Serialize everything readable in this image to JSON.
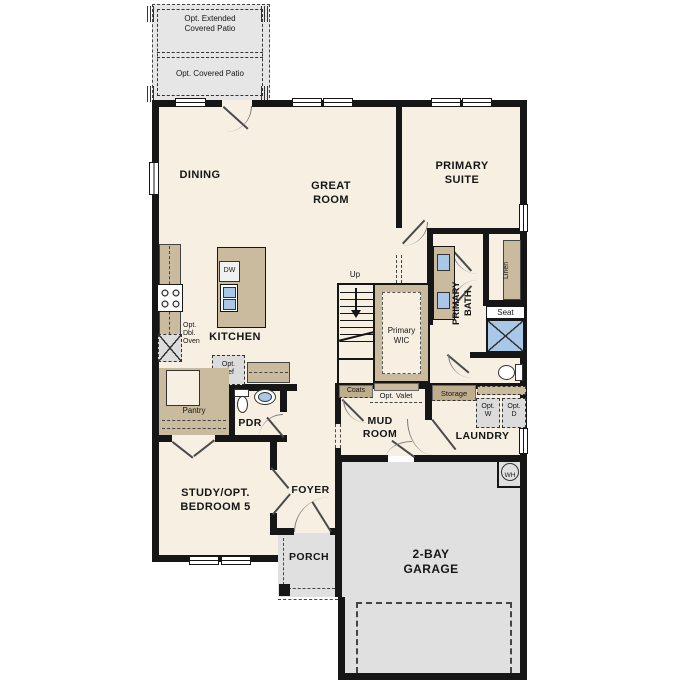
{
  "title": "Single-story floor plan",
  "colors": {
    "floor": "#f6efe2",
    "wall": "#161616",
    "cabinet_tan": "#cabb9f",
    "header_tan": "#bfae8e",
    "garage_gray": "#e0e0e0",
    "fixture_blue": "#a9c7e6",
    "option_box_gray": "#dcdcdc"
  },
  "labels": {
    "patio_extended": "Opt. Extended\nCovered Patio",
    "patio_covered": "Opt. Covered Patio",
    "dining": "DINING",
    "great_room": "GREAT\nROOM",
    "primary_suite": "PRIMARY\nSUITE",
    "kitchen": "KITCHEN",
    "dw": "DW",
    "opt_dbl_oven": "Opt.\nDbl.\nOven",
    "opt_ref": "Opt.\nRef",
    "pantry": "Pantry",
    "pdr": "PDR",
    "up": "Up",
    "primary_wic": "Primary\nWIC",
    "primary_bath": "PRIMARY\nBATH",
    "linen": "Linen",
    "seat": "Seat",
    "coats": "Coats",
    "opt_valet": "Opt. Valet",
    "storage": "Storage",
    "opt_w": "Opt.\nW",
    "opt_d": "Opt.\nD",
    "mud_room": "MUD\nROOM",
    "laundry": "LAUNDRY",
    "study": "STUDY/OPT.\nBEDROOM 5",
    "foyer": "FOYER",
    "porch": "PORCH",
    "garage": "2-BAY\nGARAGE",
    "wh": "WH"
  }
}
